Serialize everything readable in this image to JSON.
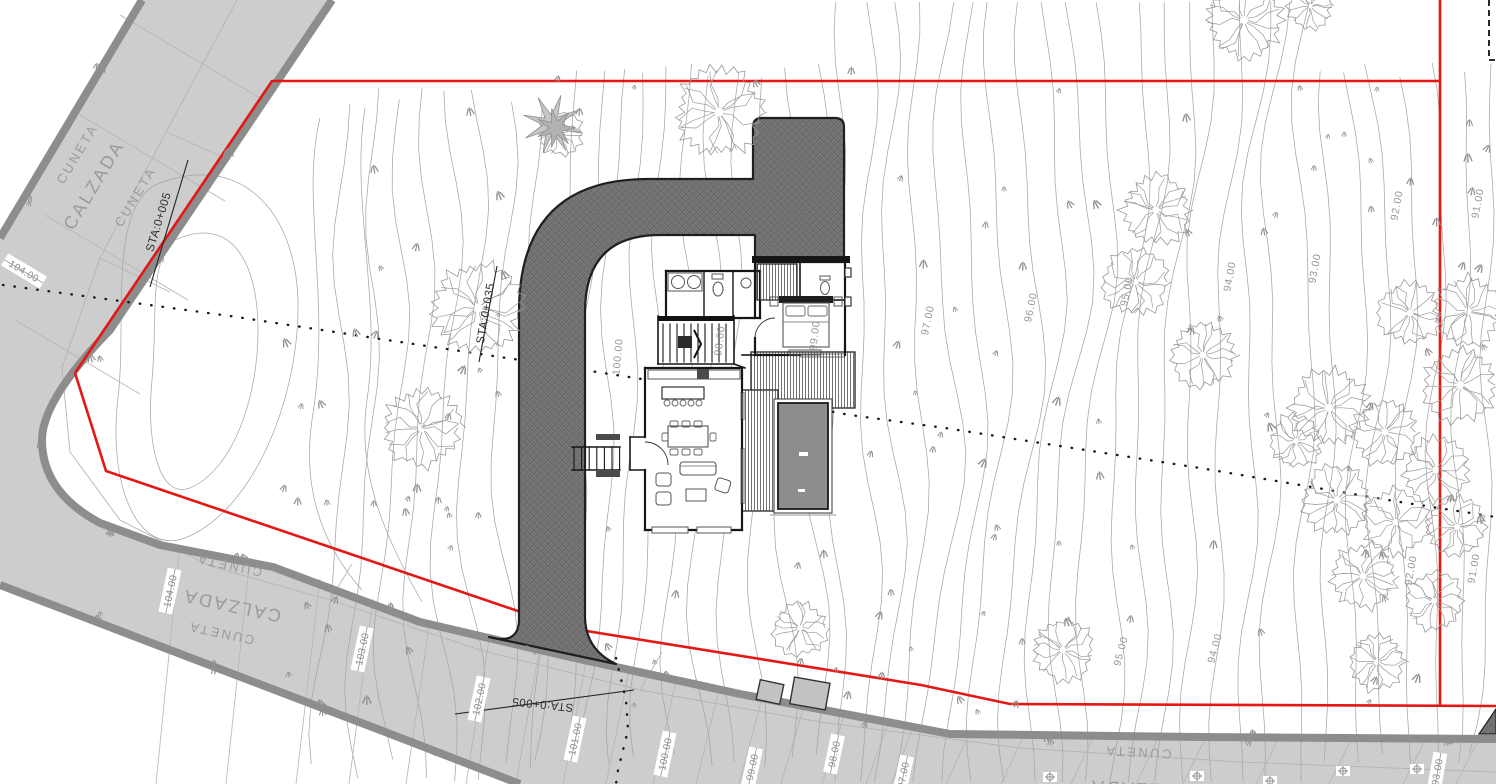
{
  "road_labels": [
    {
      "text": "CUNETA",
      "x": 81,
      "y": 156,
      "rot": -59,
      "size": 13
    },
    {
      "text": "CALZADA",
      "x": 99,
      "y": 188,
      "rot": -59,
      "size": 18
    },
    {
      "text": "CUNETA",
      "x": 139,
      "y": 199,
      "rot": -59,
      "size": 13
    },
    {
      "text": "CUNETA",
      "x": 230,
      "y": 561,
      "rot": 192,
      "size": 13
    },
    {
      "text": "CALZADA",
      "x": 233,
      "y": 600,
      "rot": 192,
      "size": 18
    },
    {
      "text": "CUNETA",
      "x": 222,
      "y": 629,
      "rot": 192,
      "size": 13
    },
    {
      "text": "CUNETA",
      "x": 1138,
      "y": 748,
      "rot": 183,
      "size": 13
    },
    {
      "text": "CALZADA",
      "x": 1140,
      "y": 783,
      "rot": 183,
      "size": 18
    }
  ],
  "station_labels": [
    {
      "text": "STA:0+005",
      "x": 162,
      "y": 223,
      "rot": -73
    },
    {
      "text": "STA:0+035",
      "x": 489,
      "y": 314,
      "rot": -80
    },
    {
      "text": "STA:0+005",
      "x": 543,
      "y": 701,
      "rot": 186
    }
  ],
  "elevation_labels": [
    {
      "text": "104.00",
      "x": 24,
      "y": 271,
      "rot": 31
    },
    {
      "text": "104.00",
      "x": 170,
      "y": 591,
      "rot": -78
    },
    {
      "text": "103.00",
      "x": 362,
      "y": 649,
      "rot": -78
    },
    {
      "text": "102.00",
      "x": 479,
      "y": 699,
      "rot": -78
    },
    {
      "text": "101.00",
      "x": 575,
      "y": 739,
      "rot": -78
    },
    {
      "text": "100.00",
      "x": 665,
      "y": 754,
      "rot": -78
    },
    {
      "text": "99.00",
      "x": 752,
      "y": 767,
      "rot": -78
    },
    {
      "text": "98.00",
      "x": 834,
      "y": 754,
      "rot": -78
    },
    {
      "text": "97.00",
      "x": 903,
      "y": 775,
      "rot": -78
    },
    {
      "text": "93.00",
      "x": 1437,
      "y": 772,
      "rot": -80
    }
  ],
  "contour_labels": [
    {
      "text": "100.00",
      "x": 621,
      "y": 357,
      "rot": -85
    },
    {
      "text": "98.00",
      "x": 723,
      "y": 341,
      "rot": -83
    },
    {
      "text": "99.00",
      "x": 818,
      "y": 336,
      "rot": -83
    },
    {
      "text": "97.00",
      "x": 931,
      "y": 321,
      "rot": -78
    },
    {
      "text": "96.00",
      "x": 1034,
      "y": 308,
      "rot": -78
    },
    {
      "text": "95.00",
      "x": 1130,
      "y": 292,
      "rot": -78
    },
    {
      "text": "94.00",
      "x": 1233,
      "y": 277,
      "rot": -80
    },
    {
      "text": "93.00",
      "x": 1318,
      "y": 269,
      "rot": -80
    },
    {
      "text": "92.00",
      "x": 1400,
      "y": 206,
      "rot": -80
    },
    {
      "text": "91.00",
      "x": 1481,
      "y": 204,
      "rot": -80
    },
    {
      "text": "92.00",
      "x": 1414,
      "y": 571,
      "rot": -80
    },
    {
      "text": "91.00",
      "x": 1477,
      "y": 569,
      "rot": -80
    },
    {
      "text": "95.00",
      "x": 1124,
      "y": 652,
      "rot": -75
    },
    {
      "text": "94.00",
      "x": 1218,
      "y": 649,
      "rot": -75
    }
  ],
  "level_markers": [
    [
      1050,
      777
    ],
    [
      1197,
      776
    ],
    [
      1270,
      781
    ],
    [
      1343,
      771
    ],
    [
      1417,
      769
    ]
  ],
  "trees": [
    [
      560,
      133,
      24
    ],
    [
      719,
      112,
      45
    ],
    [
      478,
      308,
      46
    ],
    [
      422,
      428,
      40
    ],
    [
      1244,
      20,
      40
    ],
    [
      1310,
      6,
      24
    ],
    [
      1156,
      210,
      36
    ],
    [
      1135,
      282,
      34
    ],
    [
      1203,
      355,
      34
    ],
    [
      1410,
      313,
      33
    ],
    [
      1468,
      311,
      36
    ],
    [
      1460,
      385,
      38
    ],
    [
      1329,
      408,
      40
    ],
    [
      1385,
      432,
      34
    ],
    [
      1296,
      441,
      28
    ],
    [
      1436,
      470,
      34
    ],
    [
      1337,
      500,
      36
    ],
    [
      1396,
      522,
      34
    ],
    [
      1457,
      527,
      30
    ],
    [
      1363,
      576,
      34
    ],
    [
      1434,
      601,
      30
    ],
    [
      1063,
      650,
      32
    ],
    [
      1377,
      662,
      30
    ],
    [
      800,
      628,
      28
    ]
  ],
  "palm": {
    "x": 552,
    "y": 124
  },
  "colors": {
    "boundary": "#e41714",
    "road_fill": "#cdcdcd",
    "road_edge": "#8d8d8d",
    "road_line": "#b4b4b4",
    "contour": "#a6a6a6",
    "tree": "#9a9a9a",
    "driveway": "#7d7d7d",
    "wall": "#161616",
    "pool": "#8d8d8d",
    "furniture": "#666666"
  }
}
